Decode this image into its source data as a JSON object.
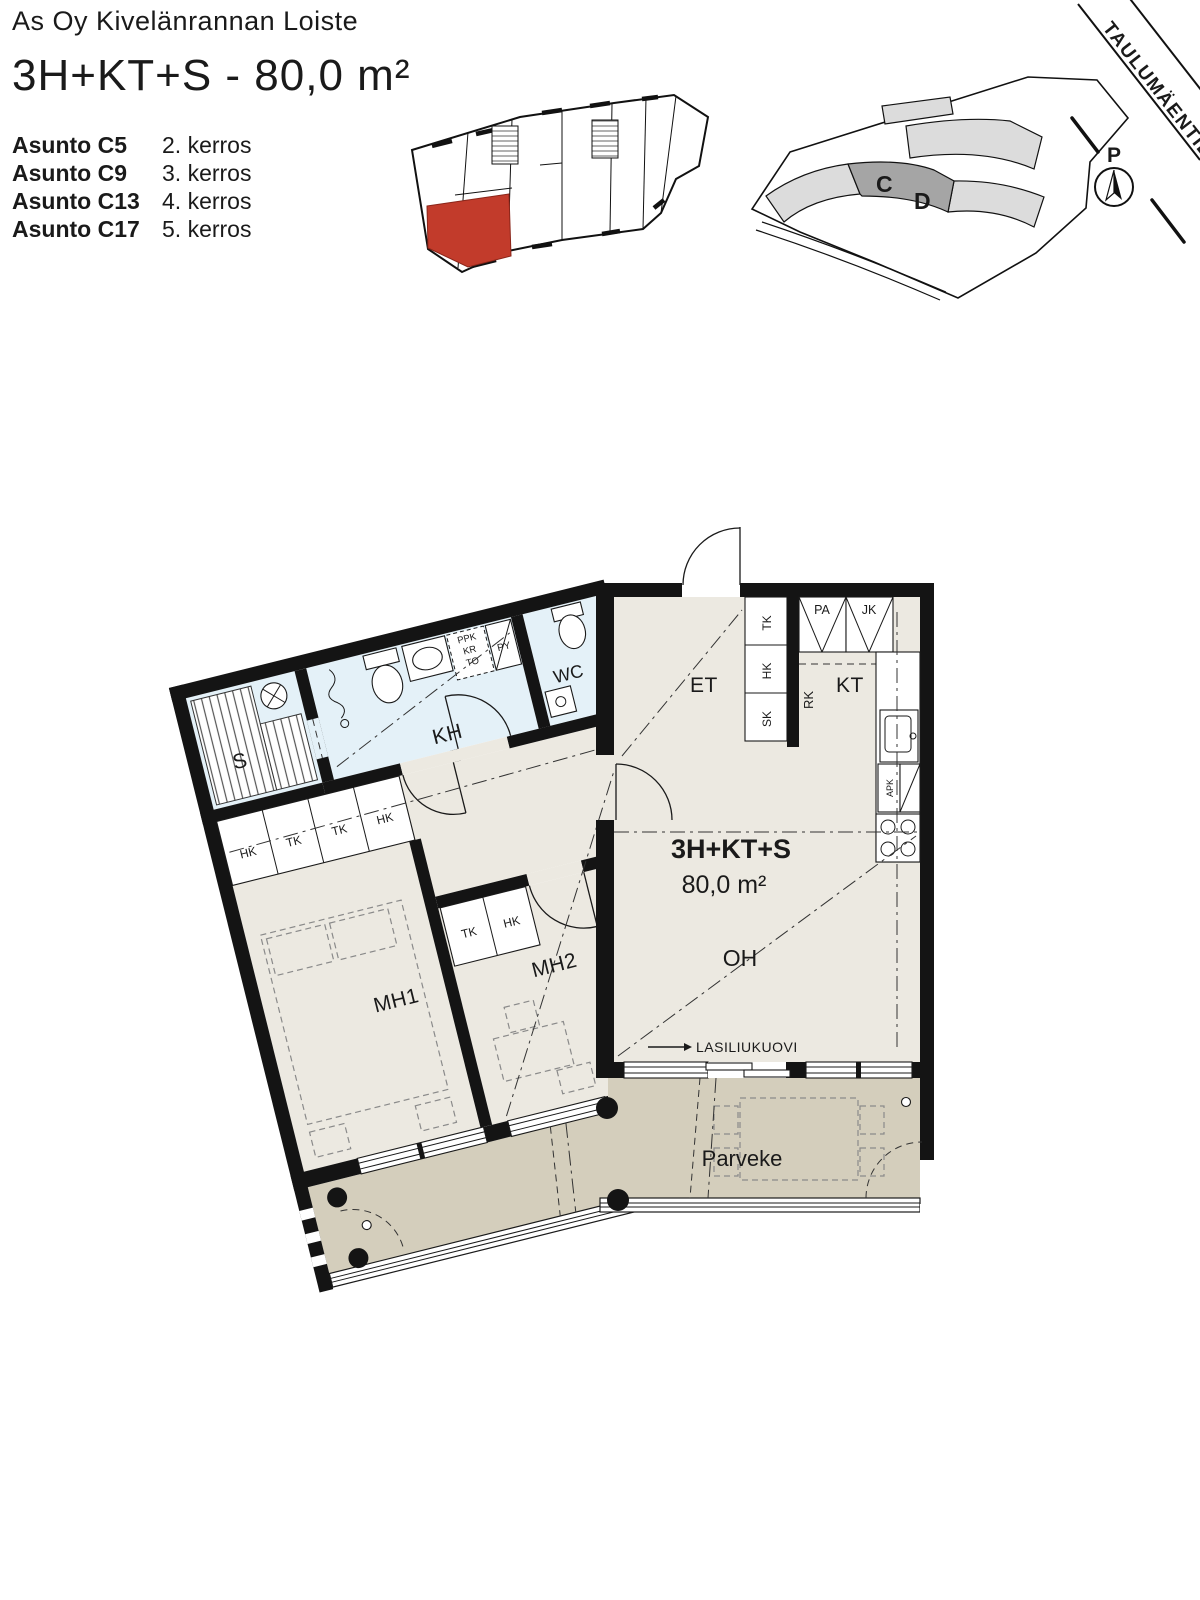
{
  "header": {
    "company": "As Oy Kivelänrannan Loiste",
    "apartment_type": "3H+KT+S - 80,0 m²",
    "units": [
      {
        "name": "Asunto C5",
        "floor": "2. kerros"
      },
      {
        "name": "Asunto C9",
        "floor": "3. kerros"
      },
      {
        "name": "Asunto C13",
        "floor": "4. kerros"
      },
      {
        "name": "Asunto C17",
        "floor": "5. kerros"
      }
    ]
  },
  "site_plan": {
    "street": "TAULUMÄENTIE",
    "building_c": "C",
    "building_d": "D",
    "north_marker": "P"
  },
  "floor_plan": {
    "area_title": "3H+KT+S",
    "area_value": "80,0 m²",
    "rooms": {
      "sauna": "S",
      "bathroom": "KH",
      "wc": "WC",
      "entry": "ET",
      "kitchen": "KT",
      "living": "OH",
      "bedroom1": "MH1",
      "bedroom2": "MH2",
      "balcony": "Parveke"
    },
    "door_label": "LASILIUKUOVI",
    "appliances": {
      "ppk": "PPK",
      "kr": "KR",
      "to": "TO",
      "py": "PY",
      "pa": "PA",
      "jk": "JK",
      "rk": "RK",
      "apk": "APK"
    },
    "closets": {
      "mh1": [
        "HK",
        "TK",
        "TK",
        "HK"
      ],
      "mh2": [
        "TK",
        "HK"
      ],
      "hall": [
        "TK",
        "HK",
        "SK"
      ]
    },
    "colors": {
      "highlight_unit": "#c23b2b",
      "wet_room": "#e4f1f8",
      "floor": "#ece9e1",
      "balcony": "#d4cebc"
    }
  }
}
